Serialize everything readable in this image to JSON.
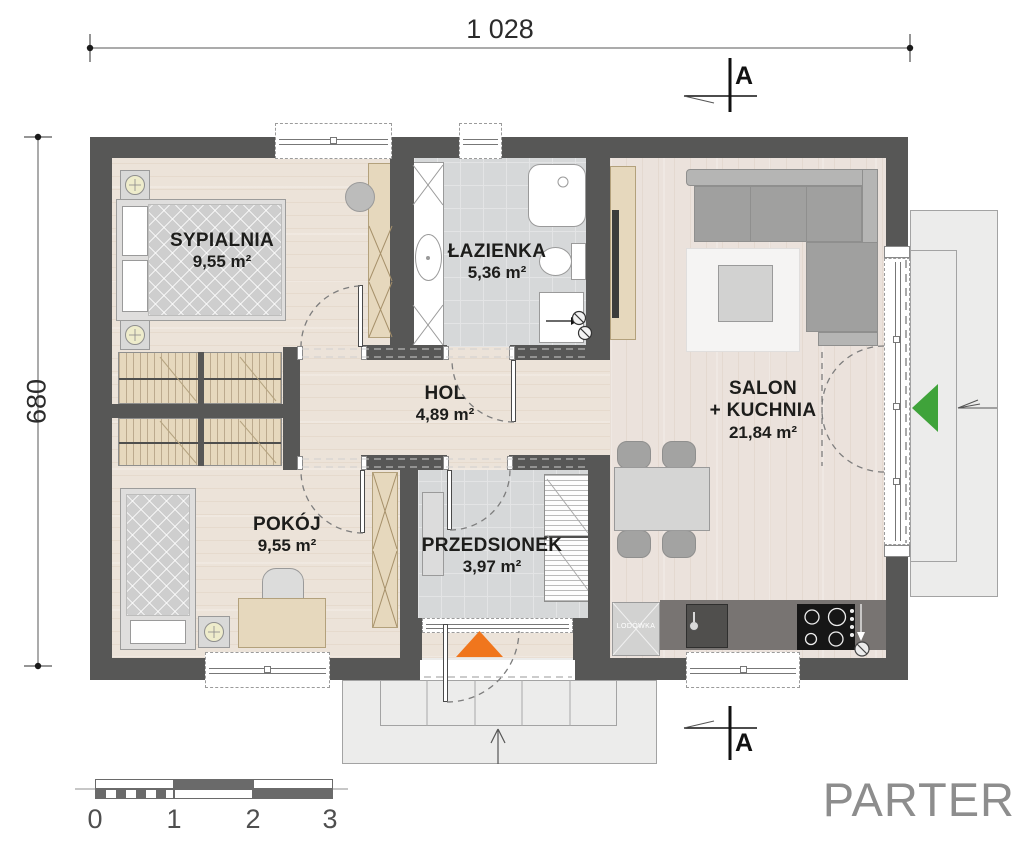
{
  "plan": {
    "floor_label": "PARTER",
    "dim_top": "1 028",
    "dim_left": "680",
    "section_top": "A",
    "section_bottom": "A"
  },
  "rooms": [
    {
      "id": "sypialnia",
      "name": "SYPIALNIA",
      "area": "9,55 m²"
    },
    {
      "id": "lazienka",
      "name": "ŁAZIENKA",
      "area": "5,36 m²"
    },
    {
      "id": "hol",
      "name": "HOL",
      "area": "4,89 m²"
    },
    {
      "id": "salon",
      "name": "SALON",
      "name2": "+ KUCHNIA",
      "area": "21,84 m²"
    },
    {
      "id": "pokoj",
      "name": "POKÓJ",
      "area": "9,55 m²"
    },
    {
      "id": "przedsionek",
      "name": "PRZEDSIONEK",
      "area": "3,97 m²"
    }
  ],
  "appliances": {
    "fridge_label": "LODÓWKA"
  },
  "scale_bar": {
    "ticks": [
      "0",
      "1",
      "2",
      "3"
    ]
  },
  "colors": {
    "wall": "#575756",
    "accent_orange": "#f0761d",
    "accent_green": "#3fa33a",
    "wood_floor": "#ece3d9",
    "tile_floor": "#d6d8d9",
    "furniture_tan": "#e6d8bd",
    "label_text": "#1d1d1b"
  }
}
